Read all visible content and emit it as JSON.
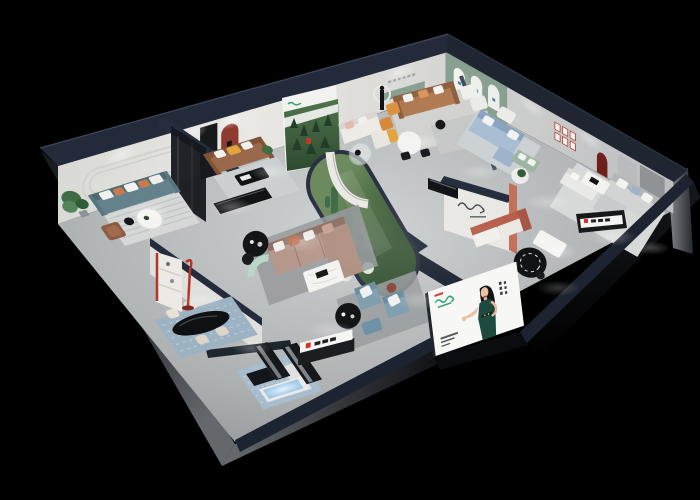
{
  "meta": {
    "kind": "isometric-3d-showroom-floorplan-render",
    "canvas": {
      "width": 700,
      "height": 500
    }
  },
  "palette": {
    "background": "#000000",
    "wall_top_navy": "#232a3a",
    "wall_lit": "#e8e7e3",
    "wall_shade": "#c7c9ca",
    "floor_light": "#ced1d1",
    "floor_dark": "#8f9395",
    "exterior_gray": "#5a5e62",
    "sage_green": "#87a090",
    "accent_arch_red": "#8e3a2e",
    "brand_red": "#d43224",
    "logo_green": "#2fa36b",
    "atrium_green": "#577549",
    "glass_tint": "#b9c6cc",
    "teal_sofa": "#63828c",
    "brown_leather_sofa": "#9a684a",
    "caramel_sofa": "#b07a52",
    "blue_sofa": "#a9bdd3",
    "green_loveseat": "#9cb6a3",
    "mauve_sofa": "#b5968a",
    "terracotta": "#c4705a",
    "blue_gray_chair": "#7fa0b0",
    "orange_accent": "#e4a43c",
    "marble_white": "#f3f3f1",
    "black_furniture": "#141517",
    "rug_blue": "#9db3c4",
    "reception_glow_blue": "#b9d9f0",
    "billboard_white": "#f7f8f6",
    "dress_green": "#1d4a40",
    "skin": "#eac3a6"
  },
  "scene": {
    "description": "night-time isometric cutaway render of a furniture showroom with dark navy outer walls",
    "rooms": [
      {
        "id": "lounge-teal",
        "items": [
          "teal-sofa",
          "round-coffee-table",
          "potted-plant",
          "striped-rug",
          "leather-armchair",
          "rounded-wall-trim"
        ]
      },
      {
        "id": "lounge-leather",
        "items": [
          "brown-leather-sofa",
          "black-coffee-table",
          "red-arch-niche",
          "dark-glass-partition",
          "media-console"
        ]
      },
      {
        "id": "gallery-white",
        "items": [
          "forest-poster-wall",
          "white-sofa",
          "glass-round-table",
          "orange-chairs",
          "curved-partition"
        ]
      },
      {
        "id": "lounge-caramel",
        "items": [
          "caramel-sofa",
          "white-armchairs",
          "round-dining-set",
          "statue-and-mirror",
          "green-wall-shelf"
        ]
      },
      {
        "id": "lounge-blue",
        "items": [
          "blue-fabric-sofa",
          "green-loveseat",
          "plant-side-table",
          "sage-arched-display-wall",
          "red-frame-grid"
        ]
      },
      {
        "id": "suite-gray",
        "items": [
          "gray-sectional-sofa",
          "white-coffee-table",
          "brand-console",
          "white-daybed",
          "round-black-rug",
          "wardrobe-panels"
        ]
      },
      {
        "id": "dining",
        "items": [
          "black-oval-table",
          "cream-chairs",
          "red-floor-lamp",
          "display-shelf"
        ]
      },
      {
        "id": "reception",
        "items": [
          "white-desk",
          "glowing-blue-panel",
          "dark-benches",
          "patterned-blue-rug"
        ]
      },
      {
        "id": "lounge-center",
        "items": [
          "mauve-sectional",
          "marble-coffee-table",
          "black-side-tables",
          "mint-curved-bench"
        ]
      },
      {
        "id": "front-lounge",
        "items": [
          "blue-gray-armchairs",
          "ottoman",
          "black-round-table",
          "brand-sign"
        ]
      },
      {
        "id": "atrium",
        "items": [
          "glass-capsule",
          "cacti",
          "white-flower-bushes"
        ]
      },
      {
        "id": "script-logo-wall",
        "items": [
          "cursive-logo",
          "terracotta-column-lamp",
          "terracotta-sofa"
        ]
      }
    ],
    "billboard": {
      "figure": "woman-presenter-in-green-dress",
      "has_vertical_cjk_text": true,
      "has_small_caption_text": true
    }
  }
}
